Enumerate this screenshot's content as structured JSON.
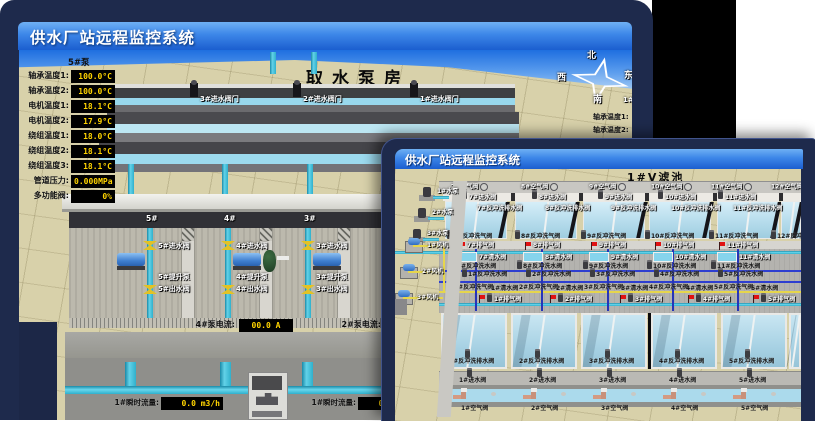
{
  "colors": {
    "window_frame": "#1e2a4c",
    "title_gradient_top": "#6fb0f4",
    "title_gradient_bottom": "#1b5ecf",
    "digital_value": "#ffd400",
    "alarm_red": "#e01212",
    "pipe_cyan": "#45c2dc",
    "valve_yellow": "#e2c226",
    "ground_tan": "#d8d1aa",
    "pool_blue": "#b6dcec"
  },
  "back_window": {
    "title": "供水厂站远程监控系统",
    "scene_title": "取水泵房",
    "pump_panel": {
      "header": "5#泵",
      "rows": [
        {
          "label": "轴承温度1:",
          "value": "100.0°C"
        },
        {
          "label": "轴承温度2:",
          "value": "100.0°C"
        },
        {
          "label": "电机温度1:",
          "value": "18.1°C"
        },
        {
          "label": "电机温度2:",
          "value": "17.9°C"
        },
        {
          "label": "绕组温度1:",
          "value": "18.0°C"
        },
        {
          "label": "绕组温度2:",
          "value": "18.1°C"
        },
        {
          "label": "绕组温度3:",
          "value": "18.1°C"
        },
        {
          "label": "管道压力:",
          "value": "0.000MPa"
        },
        {
          "label": "多功能阀:",
          "value": "0%"
        }
      ]
    },
    "intake_gates": [
      "3#进水阀门",
      "2#进水阀门",
      "1#进水阀门"
    ],
    "compass": {
      "north": "北",
      "west": "西",
      "south": "南",
      "east": "东"
    },
    "right_panel": {
      "header": "1#泵",
      "labels": [
        "轴承温度1:",
        "轴承温度2:"
      ]
    },
    "pump_bays": [
      {
        "bay": "5#",
        "inlet": "5#进水阀",
        "pump": "5#提升泵",
        "outlet": "5#出水阀"
      },
      {
        "bay": "4#",
        "inlet": "4#进水阀",
        "pump": "4#提升泵",
        "outlet": "4#出水阀"
      },
      {
        "bay": "3#",
        "inlet": "3#进水阀",
        "pump": "3#提升泵",
        "outlet": "3#出水阀"
      }
    ],
    "current_displays": [
      {
        "label": "4#泵电流:",
        "value": "00.0 A"
      },
      {
        "label": "2#泵电流:",
        "value": ""
      }
    ],
    "flow_displays": [
      {
        "label": "1#瞬时流量:",
        "value": "0.0 m3/h"
      },
      {
        "label": "1#瞬时流量:",
        "value": "0.0 m3/h"
      }
    ]
  },
  "front_window": {
    "title": "供水厂站远程监控系统",
    "scene_title": "1#V滤池",
    "top_air_valves": [
      "7#空气阀",
      "8#空气阀",
      "9#空气阀",
      "10#空气阀",
      "11#空气阀",
      "12#空气阀"
    ],
    "top_inlet_valves": [
      "7#进水阀",
      "8#进水阀",
      "9#进水阀",
      "10#进水阀",
      "11#进水阀"
    ],
    "top_drain_valves": [
      "7#反冲洗排水阀",
      "8#反冲洗排水阀",
      "9#反冲洗排水阀",
      "10#反冲洗排水阀",
      "11#反冲洗排水阀"
    ],
    "gallery_top": {
      "backwash_air": [
        "7#反冲洗气阀",
        "8#反冲洗气阀",
        "9#反冲洗气阀",
        "10#反冲洗气阀",
        "11#反冲洗气阀",
        "12#反冲洗气阀"
      ],
      "exhaust": [
        "7#排气阀",
        "8#排气阀",
        "9#排气阀",
        "10#排气阀",
        "11#排气阀"
      ],
      "clear_water": [
        "7#清水阀",
        "8#清水阀",
        "9#清水阀",
        "10#清水阀",
        "11#清水阀"
      ],
      "backwash_water": [
        "7#反冲洗水阀",
        "8#反冲洗水阀",
        "9#反冲洗水阀",
        "10#反冲洗水阀",
        "11#反冲洗水阀"
      ]
    },
    "gallery_bottom": {
      "backwash_water": [
        "1#反冲洗水阀",
        "2#反冲洗水阀",
        "3#反冲洗水阀",
        "4#反冲洗水阀",
        "5#反冲洗水阀"
      ],
      "backwash_air": [
        "1#反冲洗气阀",
        "2#反冲洗气阀",
        "3#反冲洗气阀",
        "4#反冲洗气阀",
        "5#反冲洗气阀"
      ],
      "clear_water": [
        "1#清水阀",
        "2#清水阀",
        "3#清水阀",
        "4#清水阀",
        "5#清水阀"
      ],
      "exhaust": [
        "1#排气阀",
        "2#排气阀",
        "3#排气阀",
        "4#排气阀",
        "5#排气阀"
      ]
    },
    "bottom_drain_valves": [
      "1#反冲洗排水阀",
      "2#反冲洗排水阀",
      "3#反冲洗排水阀",
      "4#反冲洗排水阀",
      "5#反冲洗排水阀"
    ],
    "bottom_inlet_valves": [
      "1#进水阀",
      "2#进水阀",
      "3#进水阀",
      "4#进水阀",
      "5#进水阀"
    ],
    "bottom_air_valves": [
      "1#空气阀",
      "2#空气阀",
      "3#空气阀",
      "4#空气阀",
      "5#空气阀"
    ],
    "left_equipment": {
      "pumps": [
        "1#水泵",
        "2#水泵",
        "3#水泵"
      ],
      "blowers": [
        "1#风机",
        "2#风机",
        "3#风机"
      ]
    }
  }
}
